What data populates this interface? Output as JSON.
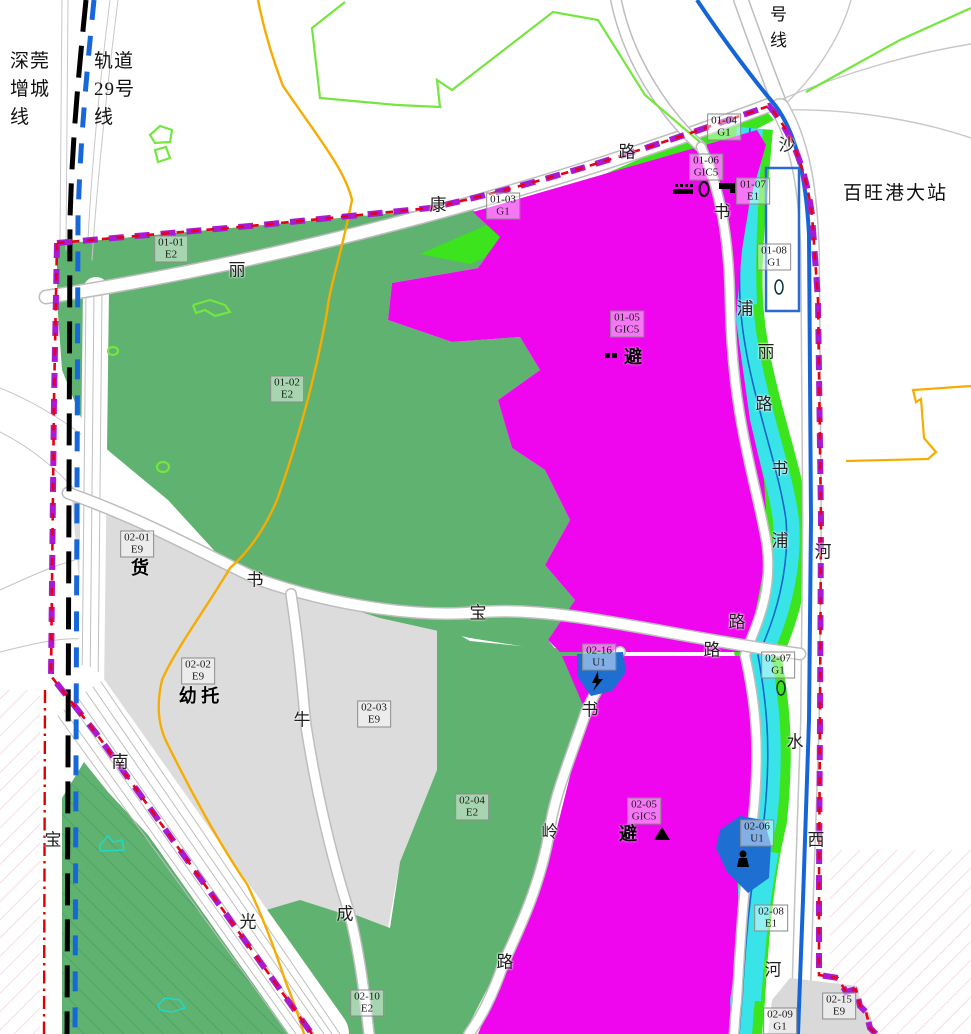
{
  "rail_lines": {
    "left_label_1": "深莞\n增城\n线",
    "left_label_2": "轨道\n29号\n线",
    "top_right_label": "号\n线",
    "station_name": "百旺港大站"
  },
  "zone_colors": {
    "E2": "#60b270",
    "E9": "#dcdcdc",
    "G1": "#3be41c",
    "GIC5": "#ef06ef",
    "E1": "#39e4e8",
    "U1": "#1d6fd2"
  },
  "line_colors": {
    "boundary_red": "#e60018",
    "boundary_purple": "#aa1ad4",
    "orange_line": "#f6ac00",
    "metro_blue": "#1565d8",
    "rail_black": "#000000",
    "rail_blue_dashed": "#1668d8"
  },
  "zones": [
    {
      "code": "01-01",
      "type": "E2",
      "x": 171,
      "y": 249
    },
    {
      "code": "01-02",
      "type": "E2",
      "x": 287,
      "y": 389
    },
    {
      "code": "01-03",
      "type": "G1",
      "x": 503,
      "y": 206
    },
    {
      "code": "01-04",
      "type": "G1",
      "x": 724,
      "y": 127
    },
    {
      "code": "01-05",
      "type": "GIC5",
      "x": 627,
      "y": 324
    },
    {
      "code": "01-06",
      "type": "GIC5",
      "x": 706,
      "y": 167
    },
    {
      "code": "01-07",
      "type": "E1",
      "x": 753,
      "y": 191
    },
    {
      "code": "01-08",
      "type": "G1",
      "x": 774,
      "y": 257
    },
    {
      "code": "02-01",
      "type": "E9",
      "x": 137,
      "y": 544
    },
    {
      "code": "02-02",
      "type": "E9",
      "x": 198,
      "y": 671
    },
    {
      "code": "02-03",
      "type": "E9",
      "x": 374,
      "y": 714
    },
    {
      "code": "02-04",
      "type": "E2",
      "x": 472,
      "y": 807
    },
    {
      "code": "02-05",
      "type": "GIC5",
      "x": 644,
      "y": 811
    },
    {
      "code": "02-06",
      "type": "U1",
      "x": 757,
      "y": 833
    },
    {
      "code": "02-07",
      "type": "G1",
      "x": 778,
      "y": 665
    },
    {
      "code": "02-08",
      "type": "E1",
      "x": 771,
      "y": 918
    },
    {
      "code": "02-09",
      "type": "G1",
      "x": 780,
      "y": 1021
    },
    {
      "code": "02-10",
      "type": "E2",
      "x": 367,
      "y": 1003
    },
    {
      "code": "02-15",
      "type": "E9",
      "x": 839,
      "y": 1006
    },
    {
      "code": "02-16",
      "type": "U1",
      "x": 599,
      "y": 657
    }
  ],
  "road_name_characters": [
    {
      "ch": "丽",
      "x": 237,
      "y": 268
    },
    {
      "ch": "康",
      "x": 438,
      "y": 203
    },
    {
      "ch": "路",
      "x": 627,
      "y": 150
    },
    {
      "ch": "沙",
      "x": 787,
      "y": 143
    },
    {
      "ch": "书",
      "x": 722,
      "y": 210
    },
    {
      "ch": "浦",
      "x": 745,
      "y": 307
    },
    {
      "ch": "丽",
      "x": 766,
      "y": 350
    },
    {
      "ch": "路",
      "x": 764,
      "y": 402
    },
    {
      "ch": "书",
      "x": 780,
      "y": 467
    },
    {
      "ch": "浦",
      "x": 780,
      "y": 539
    },
    {
      "ch": "路",
      "x": 737,
      "y": 620
    },
    {
      "ch": "河",
      "x": 823,
      "y": 550
    },
    {
      "ch": "书",
      "x": 255,
      "y": 578
    },
    {
      "ch": "宝",
      "x": 478,
      "y": 611
    },
    {
      "ch": "路",
      "x": 712,
      "y": 648
    },
    {
      "ch": "牛",
      "x": 302,
      "y": 718
    },
    {
      "ch": "书",
      "x": 590,
      "y": 708
    },
    {
      "ch": "成",
      "x": 345,
      "y": 912
    },
    {
      "ch": "岭",
      "x": 550,
      "y": 830
    },
    {
      "ch": "路",
      "x": 505,
      "y": 960
    },
    {
      "ch": "南",
      "x": 120,
      "y": 760
    },
    {
      "ch": "光",
      "x": 248,
      "y": 920
    },
    {
      "ch": "宝",
      "x": 53,
      "y": 838
    },
    {
      "ch": "水",
      "x": 795,
      "y": 740
    },
    {
      "ch": "西",
      "x": 816,
      "y": 838
    },
    {
      "ch": "河",
      "x": 773,
      "y": 968
    }
  ],
  "facility_labels": [
    {
      "text": "货",
      "x": 140,
      "y": 567
    },
    {
      "text": "幼 托",
      "x": 199,
      "y": 695
    },
    {
      "text": "避",
      "x": 633,
      "y": 356
    },
    {
      "text": "避",
      "x": 628,
      "y": 833
    }
  ],
  "icons": [
    {
      "name": "bus-stop-icon",
      "x": 683,
      "y": 190
    },
    {
      "name": "ellipse-marker-icon",
      "x": 704,
      "y": 189
    },
    {
      "name": "corner-marker-icon",
      "x": 727,
      "y": 188
    },
    {
      "name": "shelter-dots-icon",
      "x": 612,
      "y": 356
    },
    {
      "name": "lightning-icon",
      "x": 598,
      "y": 681
    },
    {
      "name": "triangle-marker-icon",
      "x": 662,
      "y": 834
    },
    {
      "name": "person-icon",
      "x": 743,
      "y": 859
    },
    {
      "name": "ring-marker-icon",
      "x": 779,
      "y": 287
    },
    {
      "name": "ring-marker-icon",
      "x": 781,
      "y": 688
    }
  ]
}
